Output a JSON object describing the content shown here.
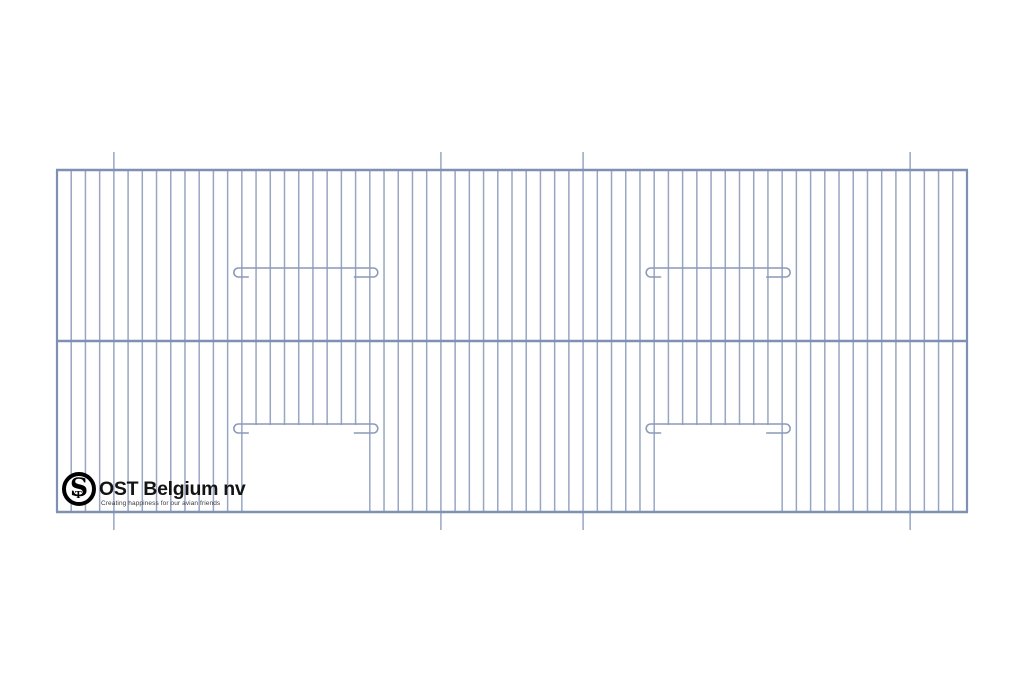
{
  "page": {
    "background_color": "#ffffff"
  },
  "drawing": {
    "type": "technical-drawing",
    "subject": "bird cage front panel: vertical wire grid with two bottom door openings, two hooked perch wires and four extended mounting wires",
    "canvas": {
      "width": 1024,
      "height": 683
    },
    "frame": {
      "left": 57,
      "top": 170,
      "right": 967,
      "bottom": 512
    },
    "rails_y": [
      170,
      341,
      512
    ],
    "wire": {
      "count": 65,
      "first_x": 57,
      "spacing": 14.21875
    },
    "extended_wire_indices": [
      4,
      27,
      37,
      60
    ],
    "extension_px": 18,
    "doors": [
      {
        "left_index": 13,
        "right_index": 22,
        "top_y": 424
      },
      {
        "left_index": 42,
        "right_index": 51,
        "top_y": 424
      }
    ],
    "perch_wires_y": 268,
    "hook": {
      "radius": 4.5,
      "drop": 9,
      "attach_offset": 3.5,
      "tail_left": 7,
      "tail_right": 16
    },
    "colors": {
      "wire": "#98a6c3",
      "rail": "#8090b2",
      "hook_wire": "#8b99b8"
    }
  },
  "logo": {
    "monogram": "S",
    "monogram_small": "T",
    "company": "OST Belgium nv",
    "tagline": "Creating happiness for our avian friends",
    "ring_color": "#000000",
    "text_color": "#141414"
  }
}
